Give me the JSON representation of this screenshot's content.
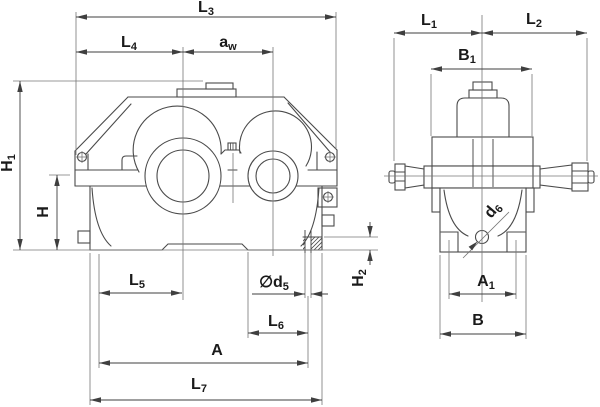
{
  "drawing": {
    "background": "#ffffff",
    "outline_color": "#4a4a4a",
    "dimension_color": "#3f3f3f",
    "text_color": "#1a1a1a"
  },
  "labels": {
    "L3": {
      "base": "L",
      "sub": "3"
    },
    "L4": {
      "base": "L",
      "sub": "4"
    },
    "aw": {
      "base": "a",
      "sub": "w"
    },
    "H1": {
      "base": "H",
      "sub": "1"
    },
    "H": {
      "base": "H",
      "sub": ""
    },
    "L5": {
      "base": "L",
      "sub": "5"
    },
    "d5": {
      "base": "∅d",
      "sub": "5"
    },
    "H2": {
      "base": "H",
      "sub": "2"
    },
    "L6": {
      "base": "L",
      "sub": "6"
    },
    "A": {
      "base": "A",
      "sub": ""
    },
    "L7": {
      "base": "L",
      "sub": "7"
    },
    "L1": {
      "base": "L",
      "sub": "1"
    },
    "L2": {
      "base": "L",
      "sub": "2"
    },
    "B1": {
      "base": "B",
      "sub": "1"
    },
    "d6": {
      "base": "d",
      "sub": "6"
    },
    "A1": {
      "base": "A",
      "sub": "1"
    },
    "B": {
      "base": "B",
      "sub": ""
    }
  }
}
